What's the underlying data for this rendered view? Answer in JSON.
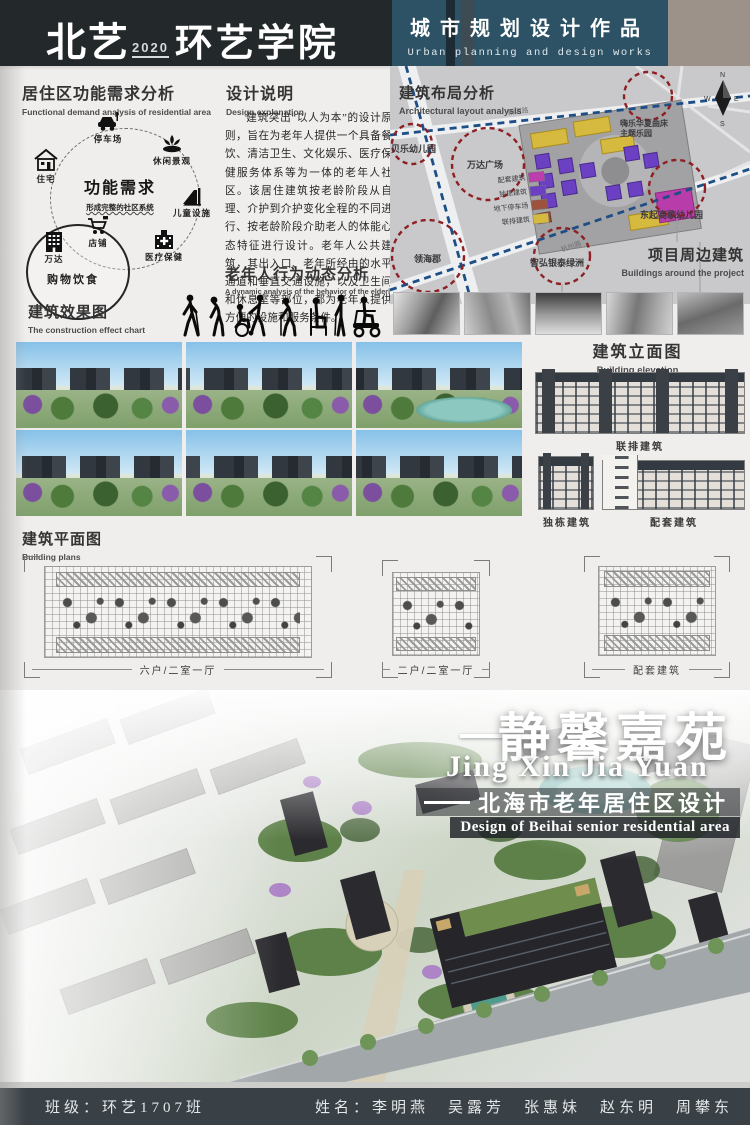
{
  "header": {
    "logo_main": "北艺",
    "logo_year": "2020",
    "logo_college": "环艺学院",
    "title_cn": "城市规划设计作品",
    "title_en": "Urban planning and design works"
  },
  "colors": {
    "header_black": "#23282b",
    "header_blue": "#2d5266",
    "header_tan": "#9c9289",
    "road_dash_blue": "#1d4e86",
    "circle_dash_red": "#8e2024",
    "footer_dark": "#394046"
  },
  "functional": {
    "title_cn": "居住区功能需求分析",
    "title_en": "Functional demand analysis of residential area",
    "center_title": "功能需求",
    "center_subtitle": "形成完整的社区系统",
    "nodes": {
      "parking": "停车场",
      "leisure": "休闲景观",
      "children": "儿童设施",
      "medical": "医疗保健",
      "shop": "店铺",
      "wanda": "万达",
      "dining": "购物饮食",
      "residence": "住宅"
    }
  },
  "design": {
    "title_cn": "设计说明",
    "title_en": "Design explanation",
    "body": "建筑突出“以人为本”的设计原则，旨在为老年人提供一个具备餐饮、清洁卫生、文化娱乐、医疗保健服务体系等为一体的老年人社区。该居住建筑按老龄阶段从自理、介护到介护变化全程的不同进行、按老龄阶段介助老人的体能心态特征进行设计。老年人公共建筑，其出入口、老年所经由的水平通道和垂直交通设施，以及卫生间和休息室等部位，都为老年人提供方便的设施和服务条件。"
  },
  "elderly": {
    "title_cn": "老年人行为动态分析",
    "title_en": "A dynamic analysis of the behavior of the elderly"
  },
  "map": {
    "title_cn": "建筑布局分析",
    "title_en": "Architectural layout analysis",
    "legend": [
      {
        "label": "配套建筑",
        "color": "#bb3dae"
      },
      {
        "label": "独栋建筑",
        "color": "#6b40c2"
      },
      {
        "label": "地下停车场",
        "color": "#9c523c"
      },
      {
        "label": "联排建筑",
        "color": "#d6b93f"
      }
    ],
    "labels": {
      "kindergarten_w": "贝乐幼儿园",
      "wanda_plaza": "万达广场",
      "linghaijun": "领海郡",
      "yintai": "智弘银泰绿洲",
      "kindergarten_e": "东起高歌幼儿园",
      "theme_park_1": "嗨乐华夏曲床",
      "theme_park_2": "主题乐园"
    },
    "roads": {
      "xinhe": "新河路",
      "hangzhou": "杭州路"
    },
    "compass": {
      "n": "N",
      "w": "W",
      "e": "E",
      "s": "S"
    },
    "surroundings_cn": "项目周边建筑",
    "surroundings_en": "Buildings around the project"
  },
  "effect": {
    "title_cn": "建筑效果图",
    "title_en": "The construction effect chart"
  },
  "elevation": {
    "title_cn": "建筑立面图",
    "title_en": "Building elevation",
    "townhouse": "联排建筑",
    "detached": "独栋建筑",
    "support": "配套建筑"
  },
  "plans": {
    "title_cn": "建筑平面图",
    "title_en": "Building plans",
    "plan1": "六户/二室一厅",
    "plan2": "二户/二室一厅",
    "plan3": "配套建筑"
  },
  "project": {
    "title_cn": "静馨嘉苑",
    "pinyin": "Jing Xin Jia Yuan",
    "subtitle_cn": "北海市老年居住区设计",
    "subtitle_en": "Design of Beihai senior residential area"
  },
  "footer": {
    "class_info": "班级：环艺1707班",
    "names": "姓名：李明燕　吴露芳　张惠妹　赵东明　周攀东"
  }
}
